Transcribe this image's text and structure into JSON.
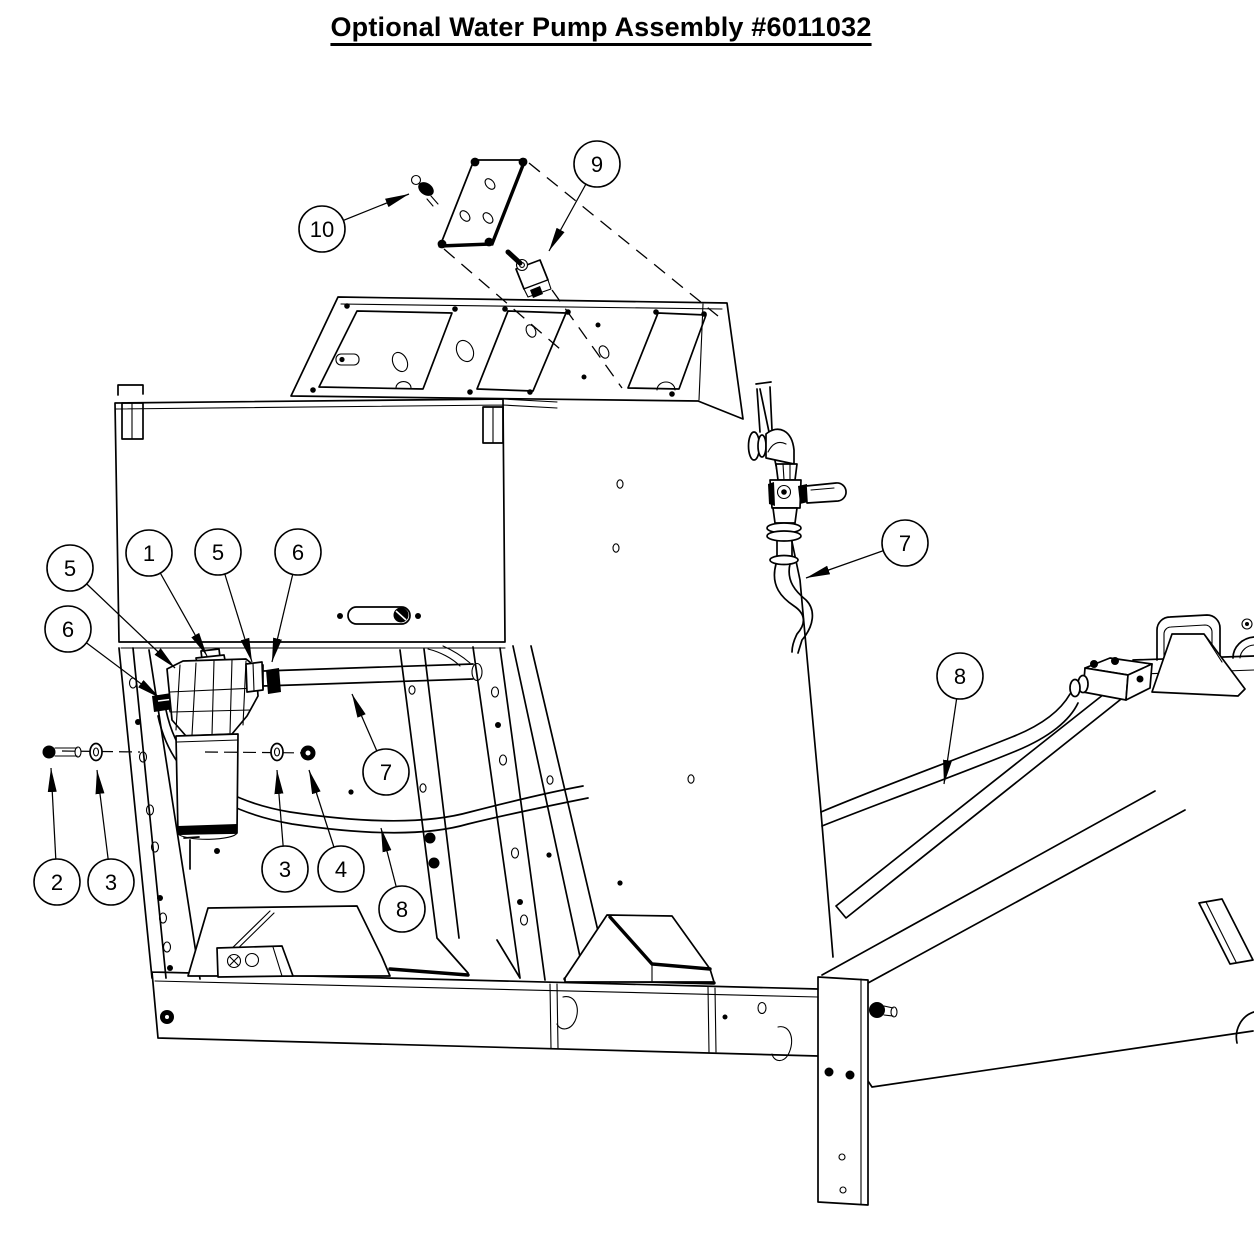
{
  "title": "Optional Water Pump Assembly #6011032",
  "diagram": {
    "type": "exploded-parts-diagram",
    "callouts": [
      {
        "label": "1"
      },
      {
        "label": "2"
      },
      {
        "label": "3"
      },
      {
        "label": "3"
      },
      {
        "label": "4"
      },
      {
        "label": "5"
      },
      {
        "label": "5"
      },
      {
        "label": "6"
      },
      {
        "label": "6"
      },
      {
        "label": "7"
      },
      {
        "label": "7"
      },
      {
        "label": "8"
      },
      {
        "label": "8"
      },
      {
        "label": "9"
      },
      {
        "label": "10"
      }
    ],
    "colors": {
      "line": "#000000",
      "background": "#ffffff"
    }
  }
}
